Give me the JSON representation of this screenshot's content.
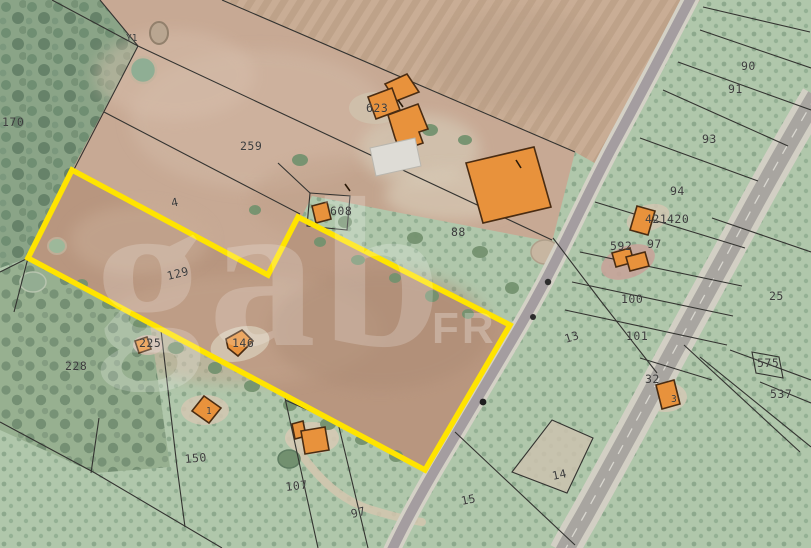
{
  "colors": {
    "highlight": "#ffe400",
    "building": "#e8923c",
    "building_outline": "#4a2c12",
    "boundary": "#2f2f2f",
    "label": "#3c3c3c"
  },
  "watermark": {
    "primary": "gab",
    "secondary": "FR"
  },
  "parcel_labels": {
    "y1": "Y1",
    "p170": "170",
    "p259": "259",
    "p4": "4",
    "p623": "623",
    "p608": "608",
    "p88": "88",
    "p129": "129",
    "p90": "90",
    "p91": "91",
    "p93": "93",
    "p94": "94",
    "p421": "421",
    "p420": "420",
    "p97_right": "97",
    "p592": "592",
    "p100": "100",
    "p101": "101",
    "p25": "25",
    "p13": "13",
    "p32": "32",
    "p575": "575",
    "p537": "537",
    "p228": "228",
    "p225": "225",
    "p146": "146",
    "p150": "150",
    "p107": "107",
    "p97_bottom": "97",
    "p15": "15",
    "p14": "14"
  },
  "building_marks": {
    "m3": "3",
    "m1": "1"
  }
}
